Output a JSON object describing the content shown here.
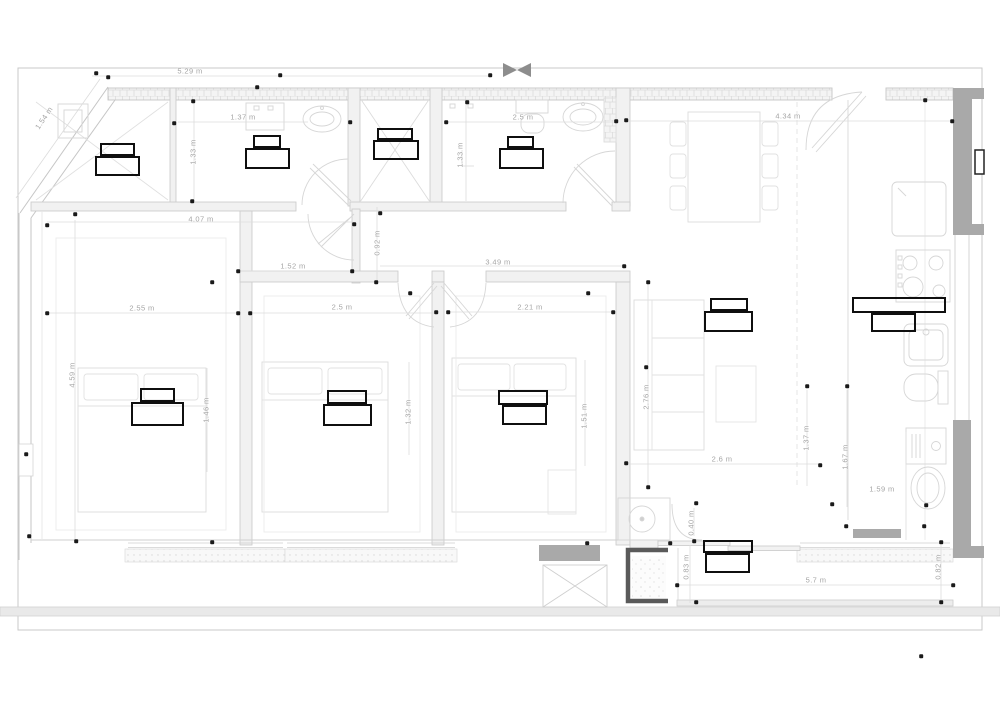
{
  "colors": {
    "line_light": "#d6d6d6",
    "line_wall": "#c7c7c7",
    "wall_fill": "#f1f1f1",
    "dark_gray_fill": "#a9a9a9",
    "marker_black": "#1a1a1a",
    "equipment_black": "#0f0f0f",
    "dim_text_gray": "#a5a5a5"
  },
  "dimension_labels": [
    {
      "text": "5.29 m",
      "x": 190,
      "y": 71,
      "rot": 0
    },
    {
      "text": "1.54 m",
      "x": 44,
      "y": 118,
      "rot": -56
    },
    {
      "text": "1.37 m",
      "x": 243,
      "y": 117,
      "rot": 0
    },
    {
      "text": "1.33 m",
      "x": 193,
      "y": 152,
      "rot": -90
    },
    {
      "text": "2.5 m",
      "x": 523,
      "y": 117,
      "rot": 0
    },
    {
      "text": "1.33 m",
      "x": 460,
      "y": 155,
      "rot": -90
    },
    {
      "text": "4.34 m",
      "x": 788,
      "y": 116,
      "rot": 0
    },
    {
      "text": "4.07 m",
      "x": 201,
      "y": 219,
      "rot": 0
    },
    {
      "text": "0.92 m",
      "x": 377,
      "y": 243,
      "rot": -90
    },
    {
      "text": "1.52 m",
      "x": 293,
      "y": 266,
      "rot": 0
    },
    {
      "text": "3.49 m",
      "x": 498,
      "y": 262,
      "rot": 0
    },
    {
      "text": "2.55 m",
      "x": 142,
      "y": 308,
      "rot": 0
    },
    {
      "text": "2.5 m",
      "x": 342,
      "y": 307,
      "rot": 0
    },
    {
      "text": "2.21 m",
      "x": 530,
      "y": 307,
      "rot": 0
    },
    {
      "text": "4.59 m",
      "x": 72,
      "y": 375,
      "rot": -90
    },
    {
      "text": "1.46 m",
      "x": 206,
      "y": 410,
      "rot": -90
    },
    {
      "text": "1.32 m",
      "x": 408,
      "y": 412,
      "rot": -90
    },
    {
      "text": "1.51 m",
      "x": 584,
      "y": 416,
      "rot": -90
    },
    {
      "text": "2.76 m",
      "x": 646,
      "y": 397,
      "rot": -90
    },
    {
      "text": "1.37 m",
      "x": 806,
      "y": 438,
      "rot": -90
    },
    {
      "text": "1.67 m",
      "x": 845,
      "y": 457,
      "rot": -90
    },
    {
      "text": "2.6 m",
      "x": 722,
      "y": 459,
      "rot": 0
    },
    {
      "text": "1.59 m",
      "x": 882,
      "y": 489,
      "rot": 0
    },
    {
      "text": "0.40 m",
      "x": 691,
      "y": 523,
      "rot": -90
    },
    {
      "text": "0.83 m",
      "x": 686,
      "y": 567,
      "rot": -90
    },
    {
      "text": "0.82 m",
      "x": 938,
      "y": 567,
      "rot": -90
    },
    {
      "text": "5.7 m",
      "x": 816,
      "y": 580,
      "rot": 0
    }
  ],
  "point_markers": [
    [
      96,
      73
    ],
    [
      108,
      77
    ],
    [
      280,
      75
    ],
    [
      257,
      87
    ],
    [
      490,
      75
    ],
    [
      193,
      101
    ],
    [
      174,
      123
    ],
    [
      350,
      122
    ],
    [
      446,
      122
    ],
    [
      467,
      102
    ],
    [
      616,
      121
    ],
    [
      626,
      120
    ],
    [
      925,
      100
    ],
    [
      952,
      121
    ],
    [
      192,
      201
    ],
    [
      380,
      213
    ],
    [
      354,
      224
    ],
    [
      47,
      225
    ],
    [
      75,
      214
    ],
    [
      212,
      282
    ],
    [
      238,
      271
    ],
    [
      352,
      271
    ],
    [
      376,
      282
    ],
    [
      624,
      266
    ],
    [
      648,
      282
    ],
    [
      47,
      313
    ],
    [
      238,
      313
    ],
    [
      250,
      313
    ],
    [
      410,
      293
    ],
    [
      436,
      312
    ],
    [
      448,
      312
    ],
    [
      588,
      293
    ],
    [
      613,
      312
    ],
    [
      646,
      367
    ],
    [
      807,
      386
    ],
    [
      847,
      386
    ],
    [
      26,
      454
    ],
    [
      29,
      536
    ],
    [
      76,
      541
    ],
    [
      212,
      542
    ],
    [
      626,
      463
    ],
    [
      648,
      487
    ],
    [
      820,
      465
    ],
    [
      832,
      504
    ],
    [
      846,
      526
    ],
    [
      924,
      526
    ],
    [
      926,
      505
    ],
    [
      587,
      543
    ],
    [
      670,
      543
    ],
    [
      694,
      541
    ],
    [
      696,
      503
    ],
    [
      677,
      585
    ],
    [
      696,
      602
    ],
    [
      941,
      542
    ],
    [
      953,
      585
    ],
    [
      941,
      602
    ],
    [
      921,
      656
    ]
  ],
  "equipment_markers": [
    {
      "rects": [
        [
          100,
          143,
          35,
          13
        ],
        [
          95,
          156,
          45,
          20
        ]
      ]
    },
    {
      "rects": [
        [
          253,
          135,
          28,
          13
        ],
        [
          245,
          148,
          45,
          21
        ]
      ]
    },
    {
      "rects": [
        [
          377,
          128,
          36,
          12
        ],
        [
          373,
          140,
          46,
          20
        ]
      ]
    },
    {
      "rects": [
        [
          507,
          136,
          27,
          12
        ],
        [
          499,
          148,
          45,
          21
        ]
      ]
    },
    {
      "rects": [
        [
          140,
          388,
          35,
          14
        ],
        [
          131,
          402,
          53,
          24
        ]
      ]
    },
    {
      "rects": [
        [
          327,
          390,
          40,
          14
        ],
        [
          323,
          404,
          49,
          22
        ]
      ]
    },
    {
      "rects": [
        [
          498,
          390,
          50,
          15
        ],
        [
          502,
          405,
          45,
          20
        ]
      ]
    },
    {
      "rects": [
        [
          710,
          298,
          38,
          13
        ],
        [
          704,
          311,
          49,
          21
        ]
      ]
    },
    {
      "rects": [
        [
          852,
          297,
          94,
          16
        ],
        [
          871,
          313,
          45,
          19
        ]
      ]
    },
    {
      "rects": [
        [
          703,
          540,
          50,
          13
        ],
        [
          705,
          553,
          45,
          20
        ]
      ]
    }
  ]
}
